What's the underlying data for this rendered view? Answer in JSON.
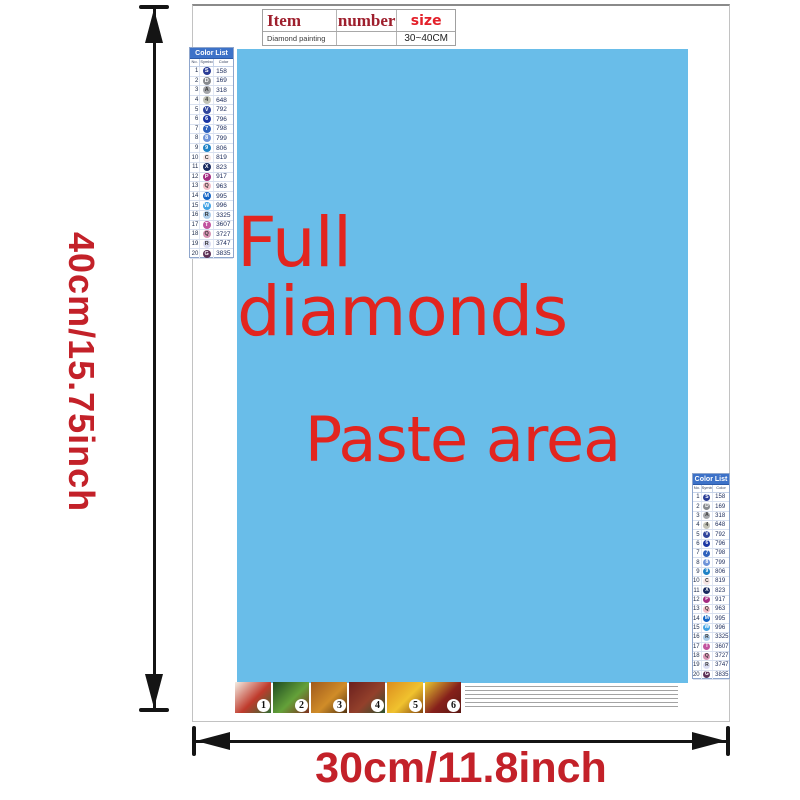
{
  "dimensions": {
    "height_label": "40cm/15.75inch",
    "width_label": "30cm/11.8inch",
    "label_color": "#c32129"
  },
  "item_table": {
    "headers": {
      "item": "Item",
      "number": "number",
      "size": "size"
    },
    "row": {
      "item": "Diamond painting",
      "number": "",
      "size": "30~40CM"
    }
  },
  "paste_area": {
    "line1": "Full diamonds",
    "line2": "Paste area",
    "bg": "#69bde9",
    "text_color": "#e2251f"
  },
  "color_list": {
    "title": "Color List",
    "columns": {
      "no": "No.",
      "symbol": "Symbol",
      "color": "Color"
    },
    "rows": [
      {
        "no": "1",
        "sym": "S",
        "code": "158",
        "bg": "#2b3d96",
        "fg": "#ffffff"
      },
      {
        "no": "2",
        "sym": "D",
        "code": "169",
        "bg": "#878a8e",
        "fg": "#ffffff"
      },
      {
        "no": "3",
        "sym": "A",
        "code": "318",
        "bg": "#a4a6aa",
        "fg": "#3a3a3a"
      },
      {
        "no": "4",
        "sym": "4",
        "code": "648",
        "bg": "#c2c3b7",
        "fg": "#3a3a3a"
      },
      {
        "no": "5",
        "sym": "V",
        "code": "792",
        "bg": "#30459c",
        "fg": "#ffffff"
      },
      {
        "no": "6",
        "sym": "6",
        "code": "796",
        "bg": "#1c37a4",
        "fg": "#ffffff"
      },
      {
        "no": "7",
        "sym": "7",
        "code": "798",
        "bg": "#2e61bc",
        "fg": "#ffffff"
      },
      {
        "no": "8",
        "sym": "8",
        "code": "799",
        "bg": "#6e94d9",
        "fg": "#ffffff"
      },
      {
        "no": "9",
        "sym": "9",
        "code": "806",
        "bg": "#1e82c6",
        "fg": "#ffffff"
      },
      {
        "no": "10",
        "sym": "C",
        "code": "819",
        "bg": "#f7e6e6",
        "fg": "#333333"
      },
      {
        "no": "11",
        "sym": "X",
        "code": "823",
        "bg": "#1a2a60",
        "fg": "#ffffff"
      },
      {
        "no": "12",
        "sym": "P",
        "code": "917",
        "bg": "#a52c82",
        "fg": "#ffffff"
      },
      {
        "no": "13",
        "sym": "Q",
        "code": "963",
        "bg": "#f3bdc7",
        "fg": "#333333"
      },
      {
        "no": "14",
        "sym": "M",
        "code": "995",
        "bg": "#1263c4",
        "fg": "#ffffff"
      },
      {
        "no": "15",
        "sym": "W",
        "code": "996",
        "bg": "#41a3e4",
        "fg": "#ffffff"
      },
      {
        "no": "16",
        "sym": "R",
        "code": "3325",
        "bg": "#abcce9",
        "fg": "#333333"
      },
      {
        "no": "17",
        "sym": "T",
        "code": "3607",
        "bg": "#c2549f",
        "fg": "#ffffff"
      },
      {
        "no": "18",
        "sym": "Q",
        "code": "3727",
        "bg": "#d893b4",
        "fg": "#333333"
      },
      {
        "no": "19",
        "sym": "R",
        "code": "3747",
        "bg": "#dadcf1",
        "fg": "#333333"
      },
      {
        "no": "20",
        "sym": "G",
        "code": "3835",
        "bg": "#5d3157",
        "fg": "#ffffff"
      }
    ]
  },
  "footer_steps": [
    {
      "num": "1",
      "colors": [
        "#f4eee4",
        "#bf3a2c",
        "#2f6d34"
      ]
    },
    {
      "num": "2",
      "colors": [
        "#1e4a22",
        "#64a139",
        "#80301f"
      ]
    },
    {
      "num": "3",
      "colors": [
        "#a05a1d",
        "#d08c28",
        "#553511"
      ]
    },
    {
      "num": "4",
      "colors": [
        "#6b201e",
        "#93402b",
        "#2d512f"
      ]
    },
    {
      "num": "5",
      "colors": [
        "#dc8d1e",
        "#f0c22e",
        "#84470f"
      ]
    },
    {
      "num": "6",
      "colors": [
        "#e6c631",
        "#86201b",
        "#591813"
      ]
    }
  ]
}
